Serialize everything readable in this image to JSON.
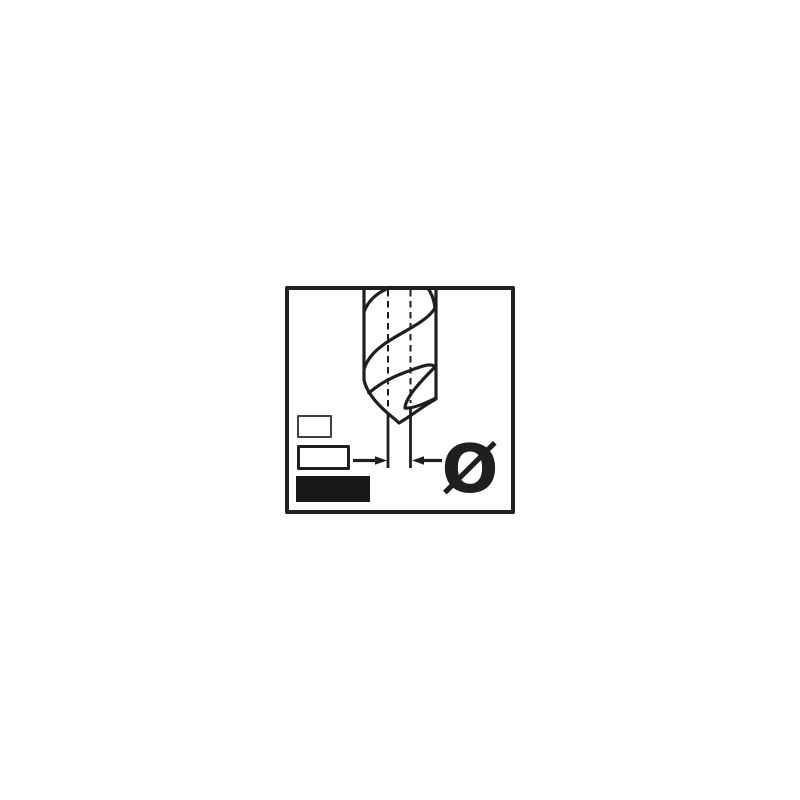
{
  "page": {
    "background_color": "#ffffff"
  },
  "pictogram": {
    "title": "drill-bit-diameter-pictogram",
    "description": "Line drawing of a twist drill bit point with dashed centerlines, inward dimension arrows and a diameter symbol; three size boxes at lower left with the largest filled solid.",
    "diameter_symbol": "Ø",
    "colors": {
      "ink": "#1f1f1f",
      "background": "#ffffff",
      "small_box_border": "#414141",
      "medium_box_border": "#1f1f1f",
      "filled_box_fill": "#171717"
    },
    "size_boxes": [
      {
        "id": "small",
        "style": "outlined"
      },
      {
        "id": "medium",
        "style": "outlined"
      },
      {
        "id": "large",
        "style": "filled"
      }
    ]
  }
}
